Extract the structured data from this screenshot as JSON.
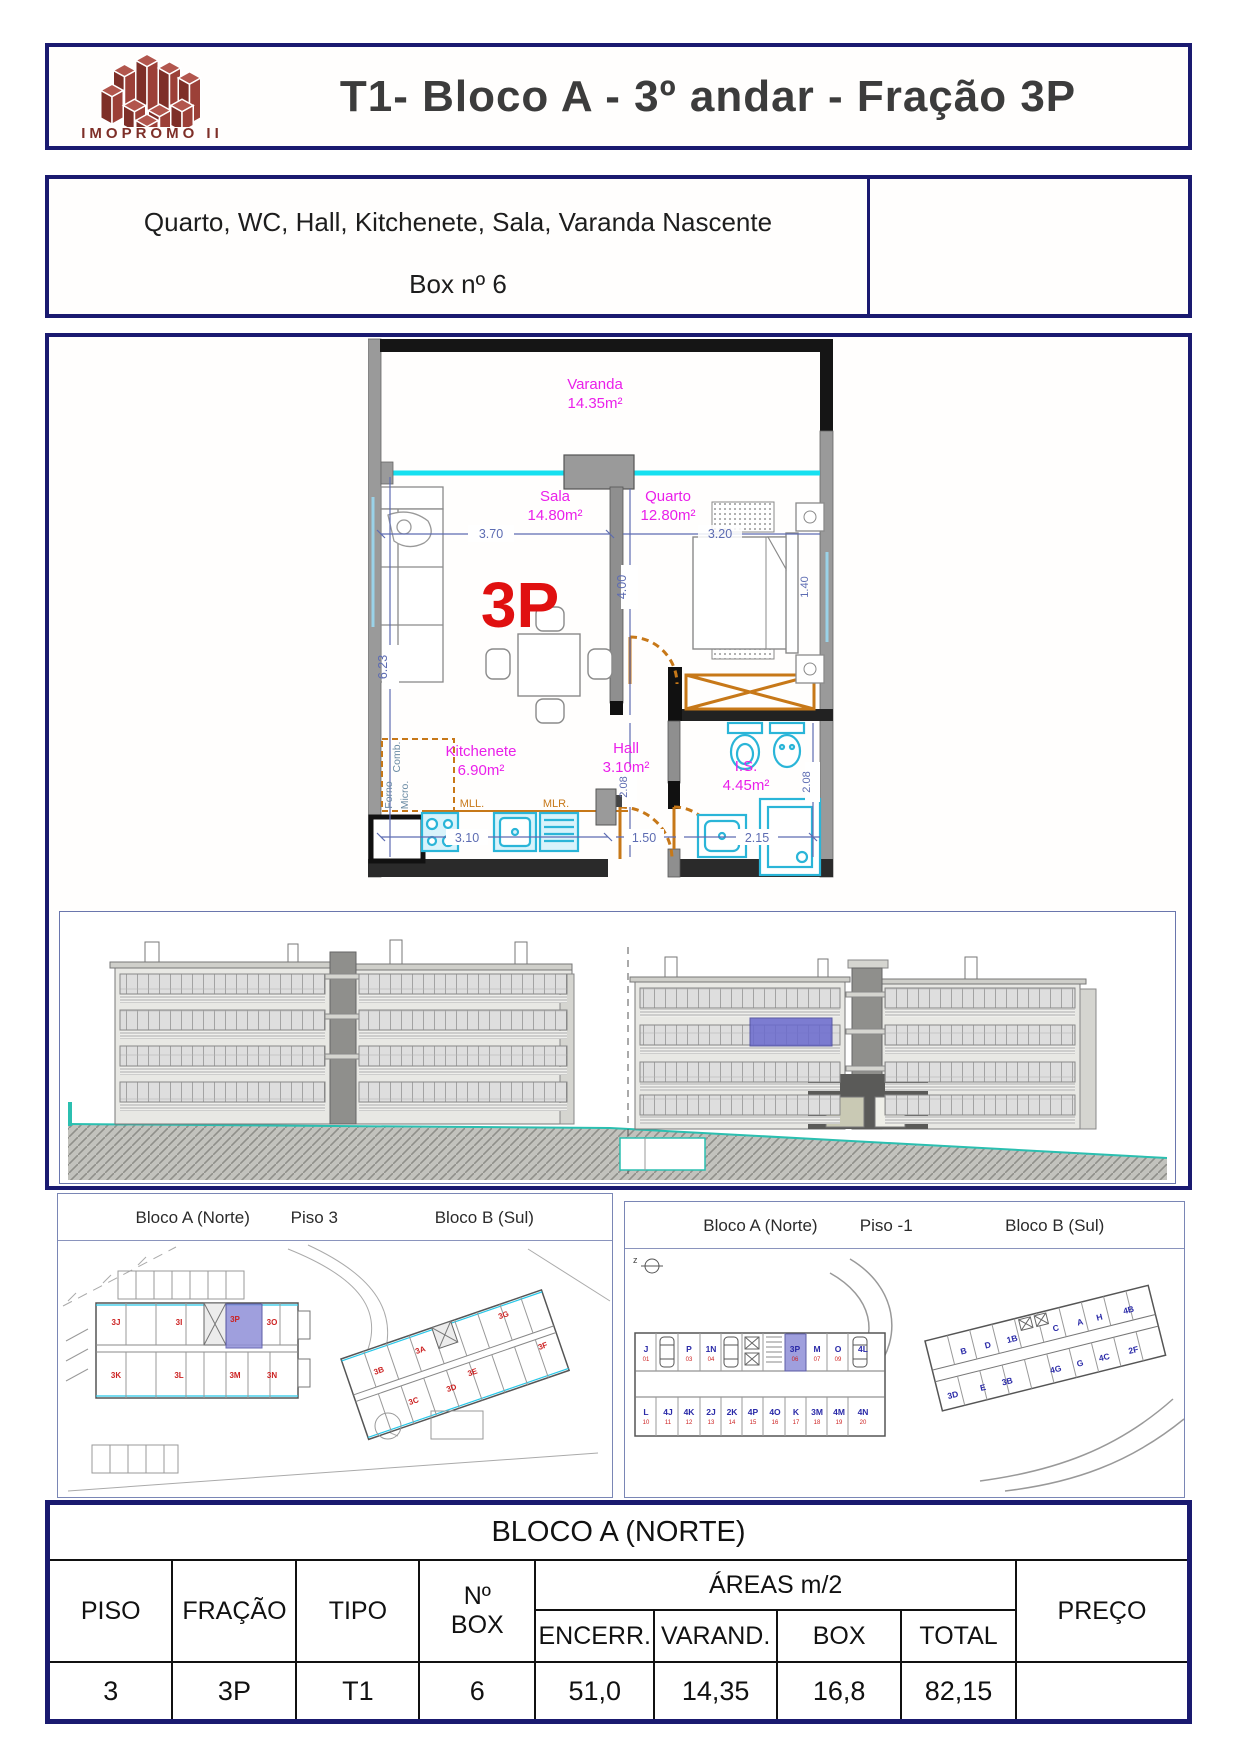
{
  "header": {
    "logo_text": "IMOPROMO II",
    "title": "T1- Bloco A - 3º andar - Fração 3P"
  },
  "subtitle": {
    "line1": "Quarto, WC, Hall, Kitchenete, Sala, Varanda Nascente",
    "line2": "Box nº 6"
  },
  "floor_plan": {
    "unit_label": "3P",
    "varanda_name": "Varanda",
    "varanda_area": "14.35m²",
    "sala_name": "Sala",
    "sala_area": "14.80m²",
    "quarto_name": "Quarto",
    "quarto_area": "12.80m²",
    "kitchenete_name": "Kitchenete",
    "kitchenete_area": "6.90m²",
    "hall_name": "Hall",
    "hall_area": "3.10m²",
    "is_name": "I.S.",
    "is_area": "4.45m²",
    "dim_sala_w": "3.70",
    "dim_quarto_w": "3.20",
    "dim_quarto_h": "4.00",
    "dim_left_h": "6.23",
    "dim_kitchen": "3.10",
    "dim_hall": "1.50",
    "dim_is": "2.15",
    "dim_hall_h": "2.08",
    "dim_is_h": "2.08",
    "dim_window": "1.40",
    "label_mll": "MLL.",
    "label_mlr": "MLR.",
    "label_comb": "Comb.",
    "label_forno": "Forno",
    "label_micro": "Micro."
  },
  "site_plan_piso3": {
    "bloco_a": "Bloco A (Norte)",
    "piso": "Piso 3",
    "bloco_b": "Bloco B (Sul)",
    "units_a_top": [
      "3J",
      "3I",
      "3P",
      "3O"
    ],
    "units_a_bottom": [
      "3K",
      "3L",
      "3M",
      "3N"
    ],
    "units_b": [
      "3B",
      "3A",
      "3G",
      "3E",
      "3C",
      "3D",
      "3F"
    ]
  },
  "site_plan_piso_1": {
    "bloco_a": "Bloco A (Norte)",
    "piso": "Piso -1",
    "bloco_b": "Bloco B (Sul)",
    "garage_top": [
      {
        "label": "J",
        "num": "01"
      },
      {
        "label": "P",
        "num": "03"
      },
      {
        "label": "1N",
        "num": "04"
      },
      {
        "label": "3P",
        "num": "06"
      },
      {
        "label": "M",
        "num": "07"
      },
      {
        "label": "O",
        "num": "09"
      },
      {
        "label": "4L",
        "num": ""
      }
    ],
    "garage_bottom": [
      {
        "label": "L",
        "num": "10"
      },
      {
        "label": "4J",
        "num": "11"
      },
      {
        "label": "4K",
        "num": "12"
      },
      {
        "label": "2J",
        "num": "13"
      },
      {
        "label": "2K",
        "num": "14"
      },
      {
        "label": "4P",
        "num": "15"
      },
      {
        "label": "4O",
        "num": "16"
      },
      {
        "label": "K",
        "num": "17"
      },
      {
        "label": "3M",
        "num": "18"
      },
      {
        "label": "4M",
        "num": "19"
      },
      {
        "label": "4N",
        "num": "20"
      }
    ],
    "units_b_top": [
      "B",
      "D",
      "1B",
      "C",
      "A",
      "H",
      "4B"
    ],
    "units_b_bottom": [
      "3D",
      "E",
      "3B",
      "4G",
      "G",
      "4C",
      "2F"
    ]
  },
  "table": {
    "title": "BLOCO A (NORTE)",
    "col_piso": "PISO",
    "col_fracao": "FRAÇÃO",
    "col_tipo": "TIPO",
    "col_nbox": "Nº BOX",
    "col_areas": "ÁREAS m/2",
    "col_encerr": "ENCERR.",
    "col_varand": "VARAND.",
    "col_box": "BOX",
    "col_total": "TOTAL",
    "col_preco": "PREÇO",
    "row": {
      "piso": "3",
      "fracao": "3P",
      "tipo": "T1",
      "n_box": "6",
      "encerr": "51,0",
      "varand": "14,35",
      "box": "16,8",
      "total": "82,15",
      "preco": ""
    }
  },
  "colors": {
    "frame_navy": "#1a1a70",
    "room_label": "#ea1fea",
    "unit_red": "#e01010",
    "dim_blue": "#5d6cb2",
    "fixture_cyan": "#2ab5d8",
    "glazing_cyan": "#16e0f0",
    "door_orange": "#c77818",
    "highlight_blue": "#7070cc",
    "logo_maroon": "#8c3831"
  }
}
